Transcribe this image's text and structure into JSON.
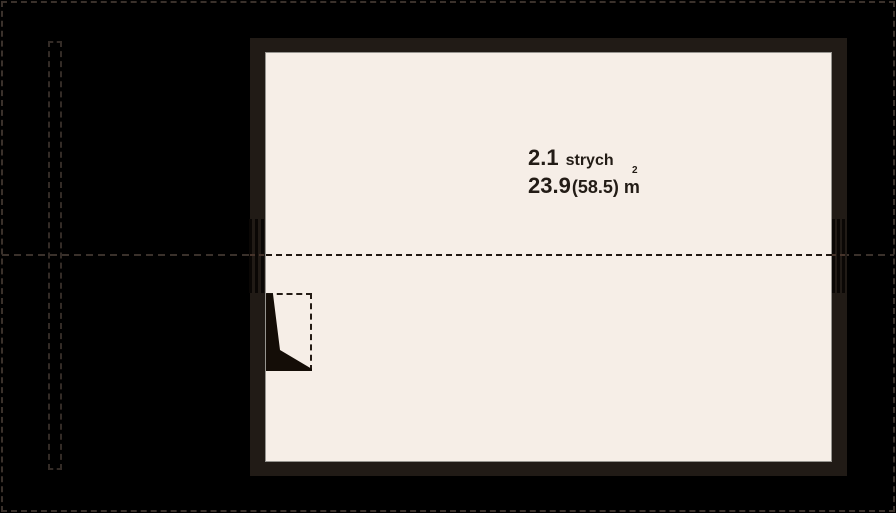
{
  "plan": {
    "room": {
      "number": "2.1",
      "name": "strych",
      "area_primary": "23.9",
      "area_secondary": "(58.5)",
      "area_unit": "m",
      "area_exponent": "2"
    },
    "colors": {
      "background": "#000000",
      "wall": "#211b16",
      "floor": "#f6eee7",
      "outer_dash": "#3a312b",
      "inner_dash": "#1f1711",
      "text": "#231c16",
      "floor_edge": "#96948f"
    }
  }
}
